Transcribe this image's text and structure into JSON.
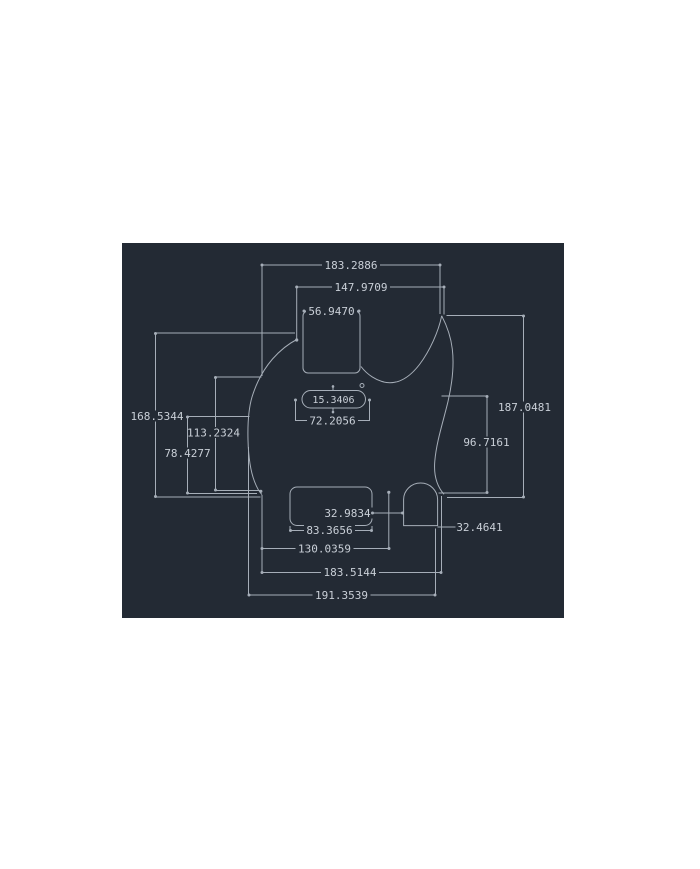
{
  "app": {
    "kind": "cad-technical-drawing",
    "subject": "telecaster-style pickguard dimensioned drawing"
  },
  "colors": {
    "canvas-bg": "#232A34",
    "line-color": "#A6AEB8",
    "text-color": "#C9CFD7",
    "page-bg": "#FFFFFF"
  },
  "drawing": {
    "dimensions": {
      "top_span_outer": "183.2886",
      "top_span_inner": "147.9709",
      "neck_pocket_width": "56.9470",
      "left_height_outer": "168.5344",
      "left_height_mid": "113.2324",
      "left_height_inner": "78.4277",
      "right_height_outer": "187.0481",
      "right_height_inner": "96.7161",
      "slot_height": "15.3406",
      "slot_width": "72.2056",
      "bridge_to_jack": "32.9834",
      "bridge_width": "83.3656",
      "jack_width": "32.4641",
      "bottom_span_inner": "130.0359",
      "bottom_span_mid": "183.5144",
      "bottom_span_outer": "191.3539"
    }
  }
}
